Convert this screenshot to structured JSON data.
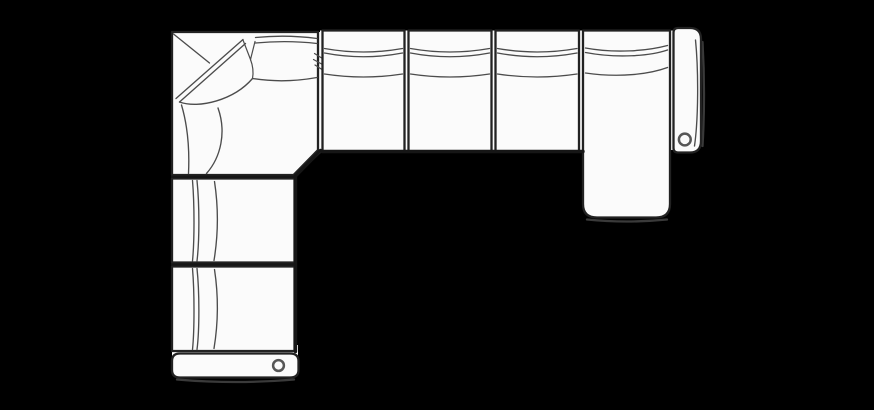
{
  "canvas": {
    "width": 874,
    "height": 410
  },
  "colors": {
    "background": "#000000",
    "upholstery": "#fbfbfb",
    "outline": "#222222",
    "seam": "#4c4c4c",
    "heavy": "#161616",
    "shadow": "#3a3a3a",
    "grommet": "#565656"
  },
  "diagram": {
    "type": "furniture-top-view-line-drawing",
    "subject": "sectional sofa plan schematic",
    "shape": "L-shaped sectional with corner wedge, chaise on right end, arm rests on right and bottom ends",
    "components": [
      {
        "id": "corner-section",
        "label": "corner wedge seat"
      },
      {
        "id": "armless-seat-1",
        "label": "armless seat"
      },
      {
        "id": "armless-seat-2",
        "label": "armless seat"
      },
      {
        "id": "armless-seat-3",
        "label": "armless seat"
      },
      {
        "id": "chaise-lounge",
        "label": "chaise seat"
      },
      {
        "id": "right-arm",
        "label": "right end arm rest"
      },
      {
        "id": "left-seat-1",
        "label": "armless seat"
      },
      {
        "id": "left-seat-2",
        "label": "armless seat"
      },
      {
        "id": "bottom-arm",
        "label": "bottom end arm rest"
      }
    ],
    "grommet_count": 2
  }
}
